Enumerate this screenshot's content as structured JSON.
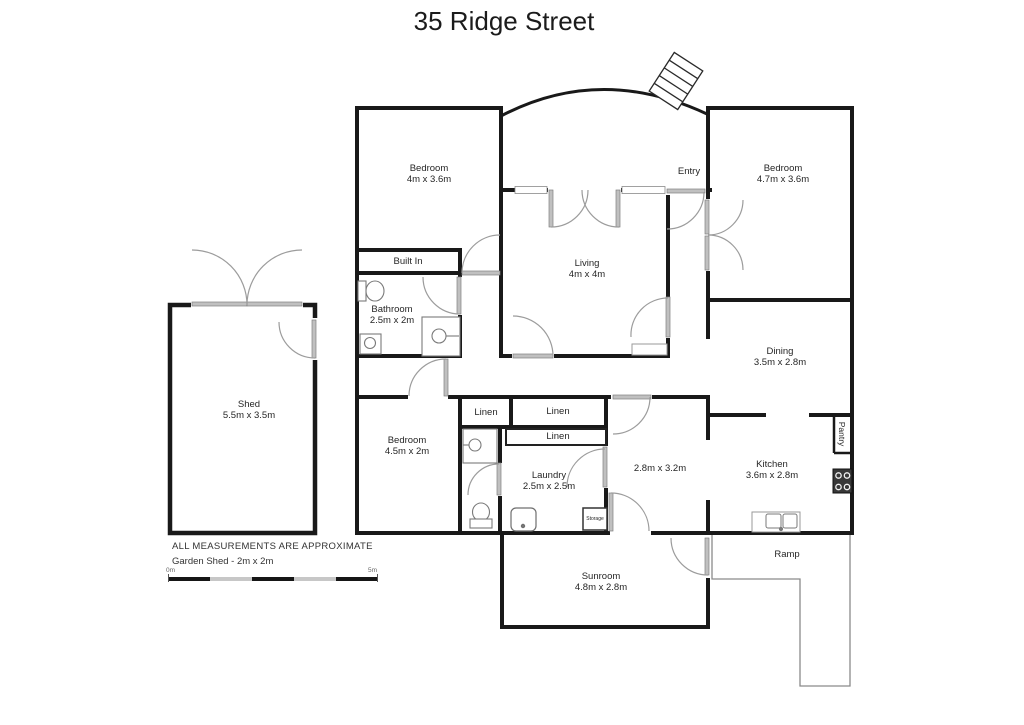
{
  "page": {
    "title": "35 Ridge Street"
  },
  "floorplan": {
    "rooms": [
      {
        "name": "Bedroom",
        "dims": "4m x 3.6m"
      },
      {
        "name": "Living",
        "dims": "4m x 4m"
      },
      {
        "name": "Bedroom",
        "dims": "4.7m x 3.6m"
      },
      {
        "name": "Dining",
        "dims": "3.5m x 2.8m"
      },
      {
        "name": "Bathroom",
        "dims": "2.5m x 2m"
      },
      {
        "name": "Bedroom",
        "dims": "4.5m x 2m"
      },
      {
        "name": "Laundry",
        "dims": "2.5m x 2.5m"
      },
      {
        "name": "",
        "dims": "2.8m x 3.2m"
      },
      {
        "name": "Kitchen",
        "dims": "3.6m x 2.8m"
      },
      {
        "name": "Sunroom",
        "dims": "4.8m x 2.8m"
      },
      {
        "name": "Shed",
        "dims": "5.5m x 3.5m"
      }
    ],
    "features": {
      "entry": "Entry",
      "built_in": "Built In",
      "linen_a": "Linen",
      "linen_b": "Linen",
      "linen_c": "Linen",
      "pantry": "Pantry",
      "storage": "Storage",
      "ramp": "Ramp"
    },
    "notes": {
      "disclaimer": "ALL MEASUREMENTS ARE APPROXIMATE",
      "garden_shed": "Garden Shed - 2m x 2m"
    },
    "scale_bar": {
      "start": "0m",
      "end": "5m"
    }
  }
}
